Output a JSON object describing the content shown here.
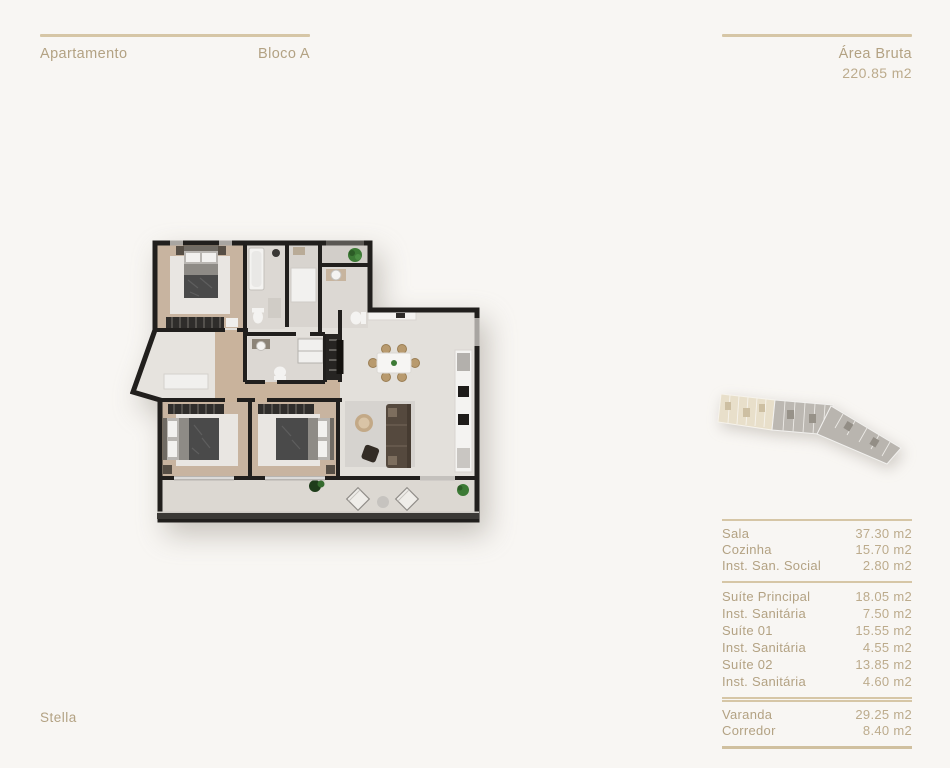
{
  "header_left": {
    "title": "Apartamento",
    "block": "Bloco A"
  },
  "header_right": {
    "label": "Área Bruta",
    "value": "220.85 m2"
  },
  "brand": {
    "name": "Stella"
  },
  "colors": {
    "background": "#f8f6f3",
    "accent_text": "#b3a283",
    "accent_line": "#d6c6a6",
    "wall": "#211f1d",
    "wood_floor": "#c9b39c",
    "key_plan_highlight": "#e8dfca"
  },
  "floor_plan": {
    "label": "apartment-floor-plan"
  },
  "key_plan": {
    "label": "building-key-plan"
  },
  "areas": {
    "group1": [
      {
        "label": "Sala",
        "value": "37.30 m2"
      },
      {
        "label": "Cozinha",
        "value": "15.70 m2"
      },
      {
        "label": "Inst. San. Social",
        "value": "2.80 m2"
      }
    ],
    "group2": [
      {
        "label": "Suíte Principal",
        "value": "18.05 m2"
      },
      {
        "label": "Inst. Sanitária",
        "value": "7.50 m2"
      },
      {
        "label": "Suíte 01",
        "value": "15.55 m2"
      },
      {
        "label": "Inst. Sanitária",
        "value": "4.55 m2"
      },
      {
        "label": "Suíte 02",
        "value": "13.85 m2"
      },
      {
        "label": "Inst. Sanitária",
        "value": "4.60 m2"
      }
    ],
    "group3": [
      {
        "label": "Varanda",
        "value": "29.25 m2"
      },
      {
        "label": "Corredor",
        "value": "8.40 m2"
      }
    ]
  }
}
